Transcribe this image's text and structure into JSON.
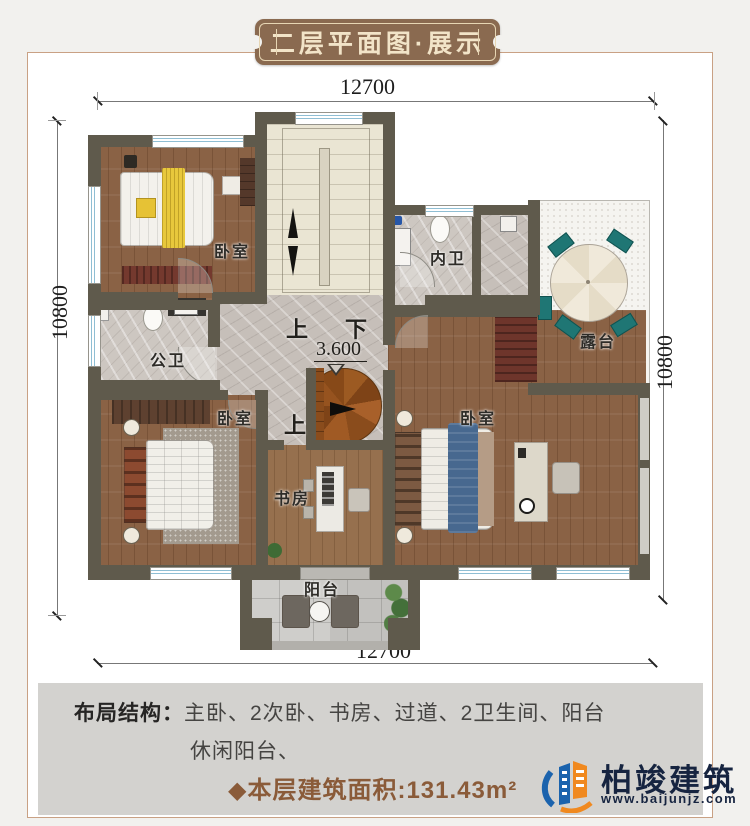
{
  "title": "二层平面图·展示",
  "dimensions": {
    "top": "12700",
    "bottom": "12700",
    "left": "10800",
    "right": "10800"
  },
  "plan": {
    "labels": {
      "bedroom_top_left": "卧室",
      "inner_bathroom": "内卫",
      "terrace": "露台",
      "public_bathroom": "公卫",
      "bedroom_bottom_left": "卧室",
      "master_bedroom": "卧室",
      "study": "书房",
      "balcony": "阳台",
      "stairs_up": "上",
      "stairs_down": "下",
      "spiral_up": "上",
      "elevation": "3.600"
    }
  },
  "info": {
    "layout_label": "布局结构：",
    "layout_items_line1": "主卧、2次卧、书房、过道、2卫生间、阳台",
    "layout_items_line2": "休闲阳台、",
    "area_text": "◆本层建筑面积:131.43m²"
  },
  "brand": {
    "name": "柏竣建筑",
    "website": "www.baijunjz.com"
  },
  "colors": {
    "badge": "#8a6a50",
    "wall": "#5f5a4c",
    "area_text": "#8a5b39",
    "brand_navy": "#162440",
    "brand_orange": "#f0891f",
    "brand_blue": "#1b63ad"
  }
}
